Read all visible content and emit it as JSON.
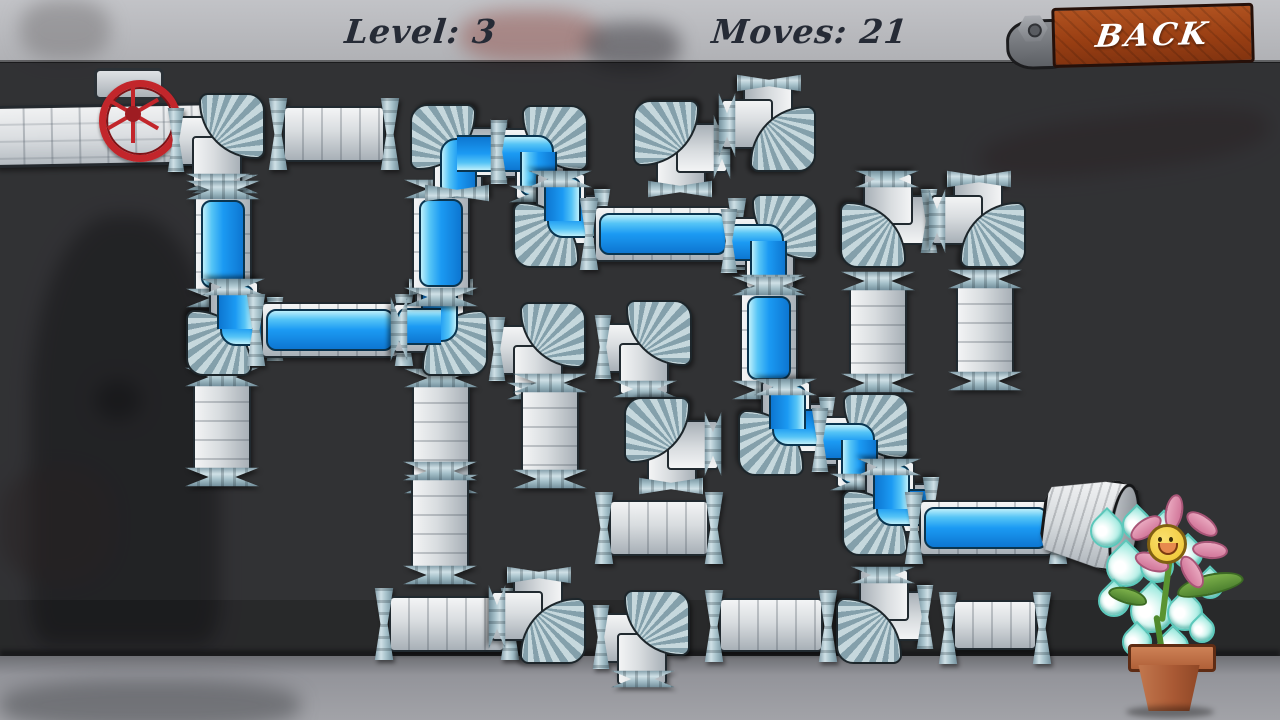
{
  "hud": {
    "level": "Level: 3",
    "moves": "Moves: 21",
    "back": "BACK"
  },
  "colors": {
    "water": "#1b9af3",
    "water_light": "#bdeffb",
    "water_dark": "#0d76d1",
    "pipe_body": "#d8dcdf",
    "flange": "#a7c2cb",
    "outline": "#212a30",
    "back_button": "#9a3f13",
    "valve": "#c2262b",
    "pot": "#aa5a35",
    "petal": "#d2779a",
    "face": "#eec42e",
    "leaf": "#4e8230",
    "drop": "#a5ebe1",
    "backdrop_wall": "#b0b1b5",
    "play_area": "#3a3a3d",
    "floor": "#93949a"
  },
  "board": {
    "pipes": [
      {
        "n": "pipe-r1c2",
        "t": "h",
        "x": 275,
        "y": 103,
        "w": 118,
        "h": 62,
        "f": 0
      },
      {
        "n": "pipe-r1c5",
        "t": "e",
        "o": "BR",
        "x": 636,
        "y": 103,
        "w": 86,
        "h": 86,
        "f": 0
      },
      {
        "n": "pipe-r1c6",
        "t": "e",
        "o": "TL",
        "x": 727,
        "y": 83,
        "w": 86,
        "h": 86,
        "f": 0
      },
      {
        "n": "pipe-r2c7",
        "t": "e",
        "o": "TR",
        "x": 843,
        "y": 179,
        "w": 86,
        "h": 86,
        "f": 0
      },
      {
        "n": "pipe-r2c8",
        "t": "e",
        "o": "TL",
        "x": 937,
        "y": 179,
        "w": 86,
        "h": 86,
        "f": 0
      },
      {
        "n": "pipe-r3c4",
        "t": "e",
        "o": "LB",
        "x": 497,
        "y": 305,
        "w": 86,
        "h": 86,
        "f": 0
      },
      {
        "n": "pipe-r3c5",
        "t": "e",
        "o": "LB",
        "x": 603,
        "y": 303,
        "w": 86,
        "h": 86,
        "f": 0
      },
      {
        "n": "pipe-r3c7",
        "t": "v",
        "x": 846,
        "y": 278,
        "w": 64,
        "h": 108,
        "f": 0
      },
      {
        "n": "pipe-r3c8",
        "t": "v",
        "x": 953,
        "y": 276,
        "w": 64,
        "h": 108,
        "f": 0
      },
      {
        "n": "pipe-r4c1",
        "t": "v",
        "x": 190,
        "y": 374,
        "w": 64,
        "h": 106,
        "f": 0
      },
      {
        "n": "pipe-r4c3",
        "t": "v",
        "x": 409,
        "y": 375,
        "w": 64,
        "h": 112,
        "f": 0
      },
      {
        "n": "pipe-r4c4",
        "t": "v",
        "x": 518,
        "y": 380,
        "w": 64,
        "h": 102,
        "f": 0
      },
      {
        "n": "pipe-r4c5",
        "t": "e",
        "o": "BR",
        "x": 627,
        "y": 400,
        "w": 86,
        "h": 86,
        "f": 0
      },
      {
        "n": "pipe-r5c3",
        "t": "v",
        "x": 408,
        "y": 468,
        "w": 64,
        "h": 110,
        "f": 0
      },
      {
        "n": "pipe-r5c5",
        "t": "h",
        "x": 601,
        "y": 497,
        "w": 116,
        "h": 62,
        "f": 0
      },
      {
        "n": "pipe-r6c3",
        "t": "h",
        "x": 381,
        "y": 593,
        "w": 132,
        "h": 62,
        "f": 0
      },
      {
        "n": "pipe-r6c4",
        "t": "e",
        "o": "TL",
        "x": 497,
        "y": 575,
        "w": 86,
        "h": 86,
        "f": 0
      },
      {
        "n": "pipe-r6c5",
        "t": "e",
        "o": "LB",
        "x": 601,
        "y": 593,
        "w": 86,
        "h": 86,
        "f": 0
      },
      {
        "n": "pipe-r6c6",
        "t": "h",
        "x": 711,
        "y": 595,
        "w": 120,
        "h": 60,
        "f": 0
      },
      {
        "n": "pipe-r6c7",
        "t": "e",
        "o": "TR",
        "x": 839,
        "y": 575,
        "w": 86,
        "h": 86,
        "f": 0
      },
      {
        "n": "pipe-r6c8",
        "t": "h",
        "x": 945,
        "y": 597,
        "w": 100,
        "h": 56,
        "f": 0
      },
      {
        "n": "source-elbow",
        "t": "e",
        "o": "LB",
        "x": 176,
        "y": 96,
        "w": 86,
        "h": 86,
        "f": 0
      },
      {
        "n": "pipe-r2c1",
        "t": "v",
        "x": 191,
        "y": 187,
        "w": 64,
        "h": 114,
        "f": 1
      },
      {
        "n": "pipe-r3c1",
        "t": "e",
        "o": "TR",
        "x": 189,
        "y": 287,
        "w": 86,
        "h": 86,
        "f": 1
      },
      {
        "n": "pipe-r3c2",
        "t": "h",
        "x": 253,
        "y": 299,
        "w": 154,
        "h": 62,
        "f": 1
      },
      {
        "n": "pipe-r3c3",
        "t": "e",
        "o": "TL",
        "x": 399,
        "y": 287,
        "w": 86,
        "h": 86,
        "f": 1
      },
      {
        "n": "pipe-r2c3",
        "t": "v",
        "x": 409,
        "y": 186,
        "w": 64,
        "h": 114,
        "f": 1
      },
      {
        "n": "pipe-r1c3",
        "t": "e",
        "o": "BR",
        "x": 413,
        "y": 107,
        "w": 86,
        "h": 86,
        "f": 1
      },
      {
        "n": "pipe-r1c4",
        "t": "e",
        "o": "LB",
        "x": 499,
        "y": 108,
        "w": 86,
        "h": 86,
        "f": 1
      },
      {
        "n": "pipe-r2c4",
        "t": "e",
        "o": "TR",
        "x": 516,
        "y": 179,
        "w": 86,
        "h": 86,
        "f": 1
      },
      {
        "n": "pipe-r2c5",
        "t": "h",
        "x": 586,
        "y": 203,
        "w": 154,
        "h": 62,
        "f": 1
      },
      {
        "n": "pipe-r2c6",
        "t": "e",
        "o": "LB",
        "x": 729,
        "y": 197,
        "w": 86,
        "h": 86,
        "f": 1
      },
      {
        "n": "pipe-r3c6",
        "t": "v",
        "x": 737,
        "y": 283,
        "w": 64,
        "h": 110,
        "f": 1
      },
      {
        "n": "pipe-r4c6",
        "t": "e",
        "o": "TR",
        "x": 741,
        "y": 387,
        "w": 86,
        "h": 86,
        "f": 1
      },
      {
        "n": "pipe-r4c7",
        "t": "e",
        "o": "LB",
        "x": 820,
        "y": 396,
        "w": 86,
        "h": 86,
        "f": 1
      },
      {
        "n": "pipe-r5c7",
        "t": "e",
        "o": "TR",
        "x": 845,
        "y": 467,
        "w": 86,
        "h": 86,
        "f": 1
      },
      {
        "n": "pipe-r5c8",
        "t": "h",
        "x": 911,
        "y": 497,
        "w": 150,
        "h": 62,
        "f": 1
      }
    ]
  },
  "scene": {
    "drops": [
      [
        1090,
        514,
        30
      ],
      [
        1122,
        510,
        26
      ],
      [
        1150,
        515,
        24
      ],
      [
        1106,
        547,
        36
      ],
      [
        1140,
        549,
        30
      ],
      [
        1173,
        539,
        26
      ],
      [
        1098,
        585,
        28
      ],
      [
        1130,
        589,
        40
      ],
      [
        1167,
        595,
        32
      ],
      [
        1196,
        571,
        24
      ],
      [
        1122,
        627,
        26
      ],
      [
        1157,
        631,
        28
      ],
      [
        1189,
        617,
        22
      ]
    ],
    "petals": [
      [
        1128,
        519,
        -35
      ],
      [
        1156,
        503,
        -80
      ],
      [
        1184,
        515,
        35
      ],
      [
        1192,
        541,
        5
      ],
      [
        1174,
        563,
        60
      ],
      [
        1134,
        553,
        20
      ]
    ]
  }
}
